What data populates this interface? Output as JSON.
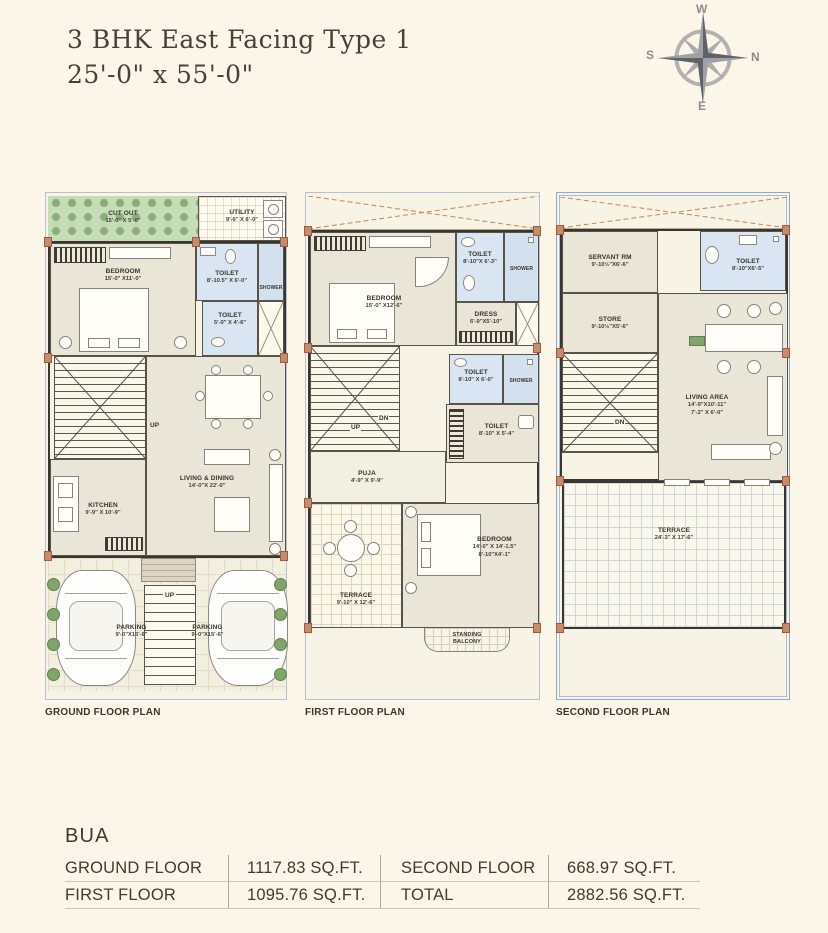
{
  "header": {
    "title": "3 BHK East Facing Type 1",
    "dimensions": "25'-0\" x 55'-0\""
  },
  "compass": {
    "west": "W",
    "north": "N",
    "east": "E",
    "south": "S"
  },
  "plans": {
    "ground": {
      "caption": "GROUND FLOOR PLAN",
      "rooms": {
        "cut_out": {
          "name": "CUT OUT",
          "dims": "15'-0\" X 5'-0\""
        },
        "utility": {
          "name": "UTILITY",
          "dims": "9'-6\" X 6'-0\""
        },
        "bedroom": {
          "name": "BEDROOM",
          "dims": "15'-0\" X11'-0\""
        },
        "toilet1": {
          "name": "TOILET",
          "dims": "8'-10.5\" X 6'-0\""
        },
        "shower": {
          "name": "SHOWER"
        },
        "toilet2": {
          "name": "TOILET",
          "dims": "5'-0\" X 4'-6\""
        },
        "stairs_up": "UP",
        "living": {
          "name": "LIVING & DINING",
          "dims": "14'-0\"X 22'-0\""
        },
        "kitchen": {
          "name": "KITCHEN",
          "dims": "9'-9\" X 10'-9\""
        },
        "parking1": {
          "name": "PARKING",
          "dims": "9'-0\"X15'-6\""
        },
        "parking2": {
          "name": "PARKING",
          "dims": "9'-0\"X15'-6\""
        },
        "entry_up": "UP"
      }
    },
    "first": {
      "caption": "FIRST FLOOR PLAN",
      "rooms": {
        "bedroom1": {
          "name": "BEDROOM",
          "dims": "15'-0\" X12'-6\""
        },
        "toilet1": {
          "name": "TOILET",
          "dims": "8'-10\"X 6'-3\""
        },
        "shower1": {
          "name": "SHOWER"
        },
        "dress": {
          "name": "DRESS",
          "dims": "6'-0\"X5'-10\""
        },
        "toilet2": {
          "name": "TOILET",
          "dims": "8'-10\" X 6'-0\""
        },
        "shower2": {
          "name": "SHOWER"
        },
        "toilet3": {
          "name": "TOILET",
          "dims": "8'-10\" X 5'-4\""
        },
        "up": "UP",
        "dn": "DN",
        "puja": {
          "name": "PUJA",
          "dims": "4'-9\" X 9'-9\""
        },
        "terrace": {
          "name": "TERRACE",
          "dims": "9'-10\" X 12'-6\""
        },
        "bedroom2": {
          "name": "BEDROOM",
          "dims": "14'-0\" X 14'-1.5\"",
          "dims2": "8'-10\"X4'-1\""
        },
        "balcony": {
          "line1": "STANDING",
          "line2": "BALCONY"
        }
      }
    },
    "second": {
      "caption": "SECOND FLOOR PLAN",
      "rooms": {
        "servant": {
          "name": "SERVANT RM",
          "dims": "9'-10½\"X6'-6\""
        },
        "store": {
          "name": "STORE",
          "dims": "9'-10½\"X5'-6\""
        },
        "toilet": {
          "name": "TOILET",
          "dims": "8'-10\"X6'-5\""
        },
        "dn": "DN",
        "living": {
          "name": "LIVING AREA",
          "dims": "14'-9\"X10'-11\"",
          "dims2": "7'-2\" X 6'-0\""
        },
        "terrace": {
          "name": "TERRACE",
          "dims": "24'-3\" X 17'-6\""
        }
      }
    }
  },
  "bua": {
    "title": "BUA",
    "rows": [
      {
        "label1": "GROUND FLOOR",
        "value1": "1117.83 SQ.FT.",
        "label2": "SECOND FLOOR",
        "value2": "668.97 SQ.FT."
      },
      {
        "label1": "FIRST FLOOR",
        "value1": "1095.76 SQ.FT.",
        "label2": "TOTAL",
        "value2": "2882.56 SQ.FT."
      }
    ]
  },
  "colors": {
    "page_bg": "#FBF6E8",
    "wall": "#39352F",
    "room_beige": "#EAE6D7",
    "toilet_blue": "#D9E5F2",
    "garden_green": "#C6DDB8",
    "column_tan": "#C08E6B",
    "compass_gray": "#9EA2A6",
    "boundary_blue": "#8FA9C7"
  }
}
